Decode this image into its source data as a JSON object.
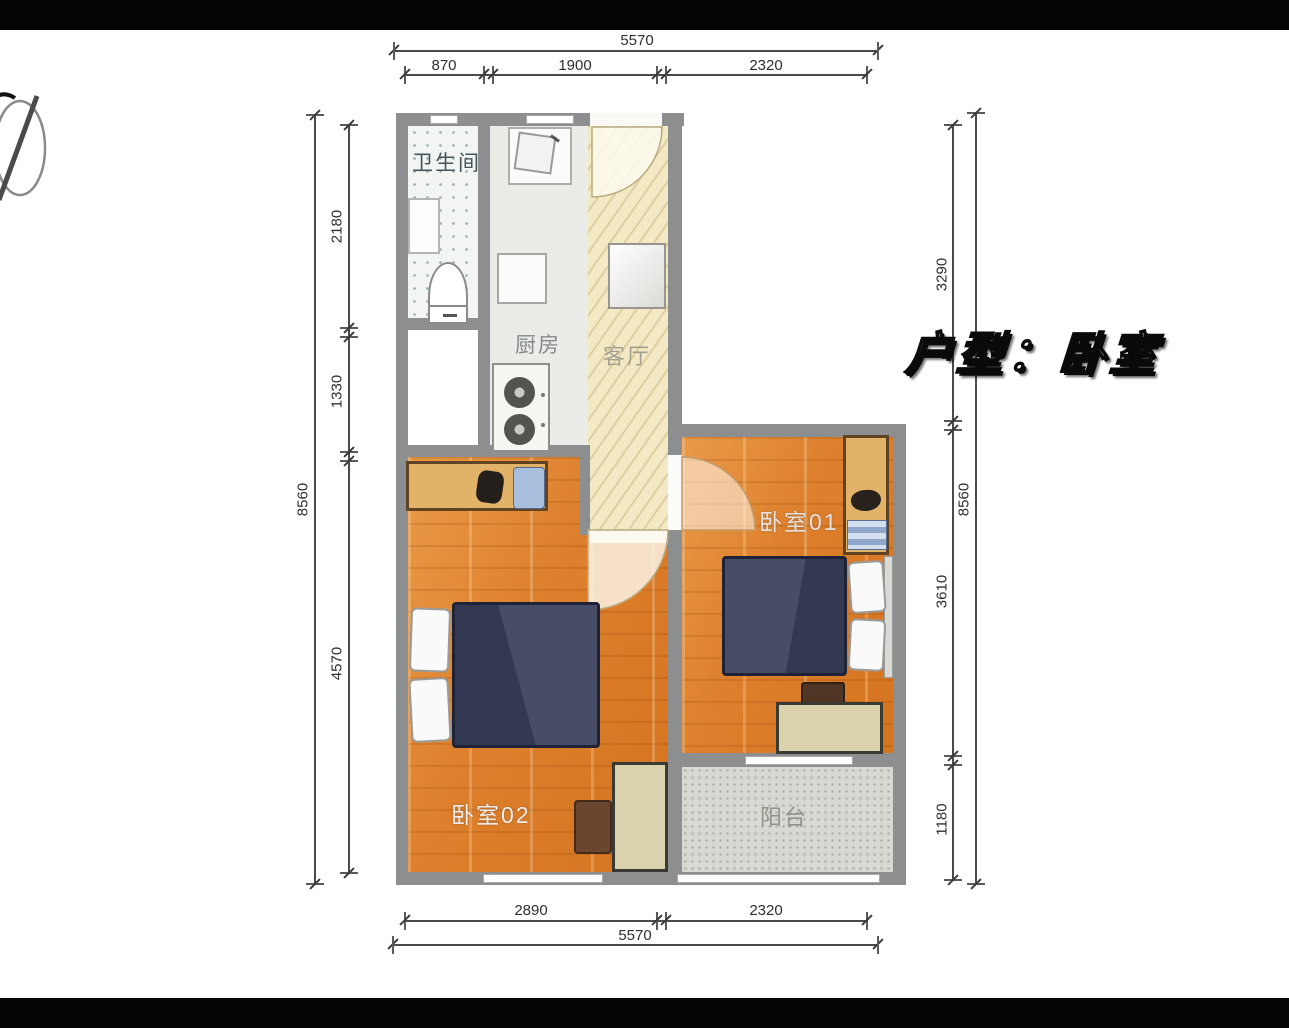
{
  "title": {
    "text": "户型：卧室"
  },
  "rooms": {
    "bathroom": {
      "label": "卫生间"
    },
    "kitchen": {
      "label": "厨房"
    },
    "living": {
      "label": "客厅"
    },
    "bedroom01": {
      "label": "卧室01"
    },
    "bedroom02": {
      "label": "卧室02"
    },
    "balcony": {
      "label": "阳台"
    }
  },
  "dimensions": {
    "top": {
      "total": "5570",
      "segments": [
        "870",
        "1900",
        "2320"
      ]
    },
    "bottom": {
      "total": "5570",
      "segments": [
        "2890",
        "2320"
      ]
    },
    "left": {
      "total": "8560",
      "segments": [
        "2180",
        "1330",
        "4570"
      ]
    },
    "right": {
      "total": "8560",
      "segments": [
        "3290",
        "3610",
        "1180"
      ]
    }
  },
  "colors": {
    "wall": "#8d8e90",
    "bedroom_floor": "#de7f2c",
    "corridor_floor": "#f3e9c4",
    "balcony_floor": "#d8d8d2",
    "bathroom_floor": "#f2f5f1",
    "kitchen_floor": "#ebece8",
    "bed": "#3c4258",
    "wardrobe_wood": "#e3b269",
    "desk_wood": "#d9d2ac"
  }
}
